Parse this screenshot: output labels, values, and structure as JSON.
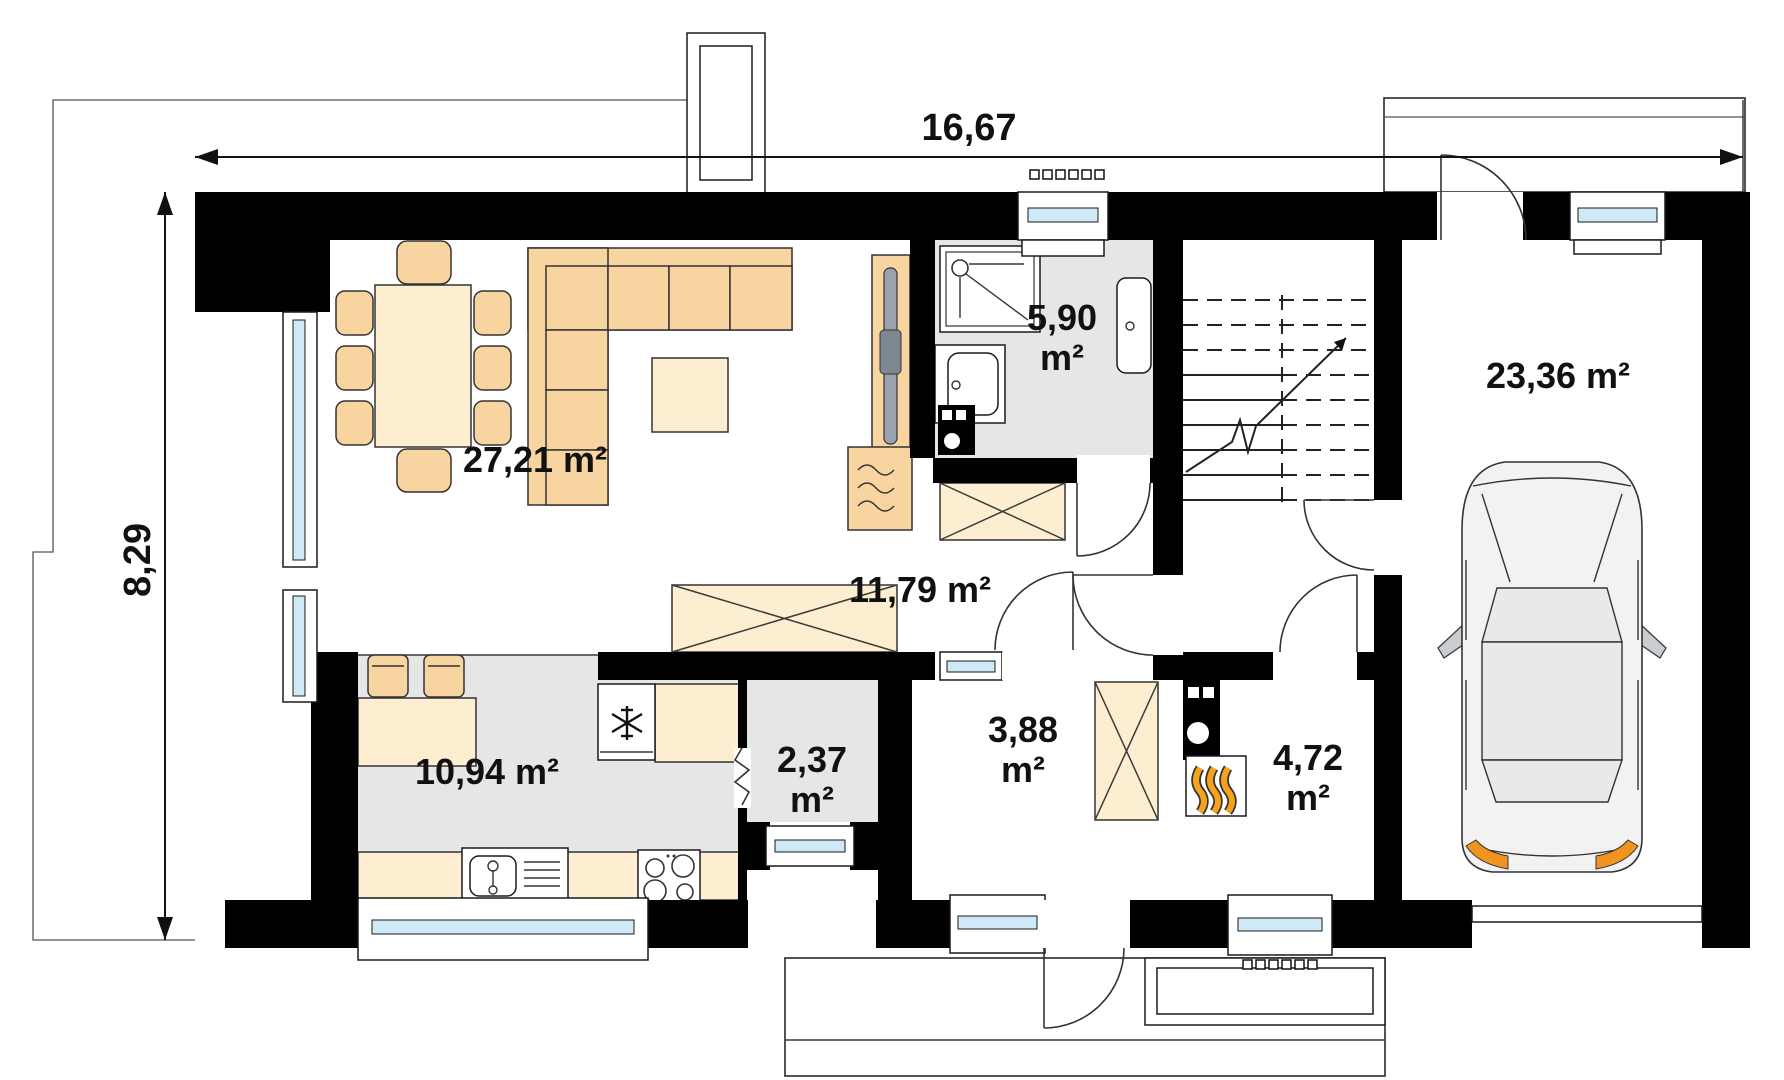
{
  "title": "house-ground-floor-plan",
  "dims": {
    "width": "16,67",
    "height": "8,29"
  },
  "rooms": {
    "living": {
      "name": "living-dining-room",
      "area": "27,21 m²"
    },
    "bathroom": {
      "name": "bathroom",
      "value": "5,90",
      "unit": "m²"
    },
    "hall": {
      "name": "hall",
      "area": "11,79 m²"
    },
    "kitchen": {
      "name": "kitchen",
      "area": "10,94 m²"
    },
    "pantry": {
      "name": "pantry",
      "value": "2,37",
      "unit": "m²"
    },
    "vestibule": {
      "name": "vestibule",
      "value": "3,88",
      "unit": "m²"
    },
    "boiler": {
      "name": "boiler-room",
      "value": "4,72",
      "unit": "m²"
    },
    "garage": {
      "name": "garage",
      "area": "23,36 m²"
    }
  },
  "symbols": [
    "snowflake-icon",
    "flame-icon",
    "shower-icon",
    "sink-icon",
    "washbasin-icon",
    "hob-icon",
    "stairs-arrow-icon",
    "car-top-view",
    "wardrobe-x",
    "fireplace-waves"
  ],
  "colors": {
    "wall": "#000000",
    "furniture": "#f8d5a0",
    "furniture_light": "#fdeed2",
    "floor_gray": "#e6e6e6",
    "window_glass": "#cfe9f7",
    "accent_orange": "#f0941f",
    "flame": "#f49b13"
  }
}
